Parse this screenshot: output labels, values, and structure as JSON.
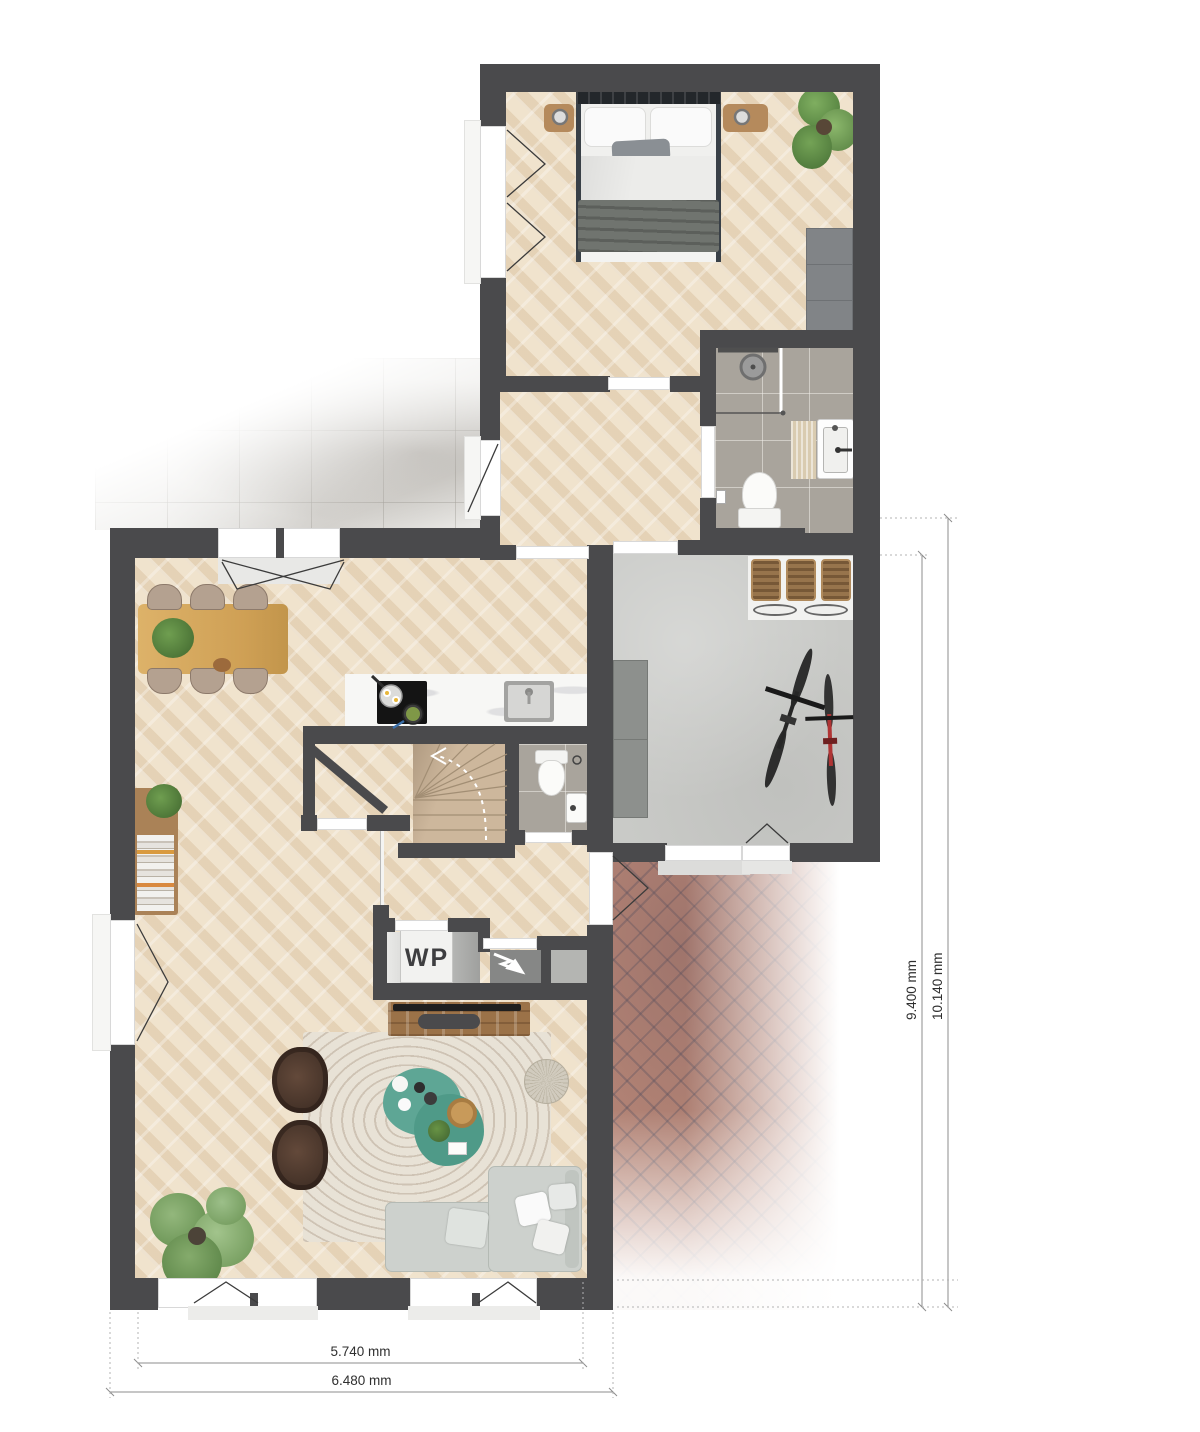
{
  "plan": {
    "type": "residential floor plan, top-down render",
    "labels": {
      "heat_pump": "WP"
    },
    "dimensions": {
      "width_inner": "5.740 mm",
      "width_outer": "6.480 mm",
      "height_inner": "9.400 mm",
      "height_outer": "10.140 mm"
    },
    "rooms_depicted": [
      "bedroom",
      "bathroom",
      "hallway",
      "terrace",
      "living-dining-kitchen",
      "stair-well",
      "wc",
      "entry",
      "garage-storage",
      "brick-driveway"
    ],
    "icons": [
      "electric-meter-lightning-icon",
      "stair-direction-arrow",
      "door-swing-marks",
      "window-swing-marks"
    ],
    "colors": {
      "wall": "#4a4a4c",
      "wood_floor": "#eedfc6",
      "terrace_tile": "#e9e8e5",
      "bathroom_tile": "#a9a49c",
      "garage_floor": "#c9cac7",
      "brick_path": "#b98878",
      "stair_tread": "#cdb79c",
      "coffee_table_accent": "#57a18f",
      "sofa": "#cdd1cd",
      "armchair": "#46342a",
      "dining_table": "#d9ae63",
      "bike_accent_red": "#b03434"
    }
  }
}
